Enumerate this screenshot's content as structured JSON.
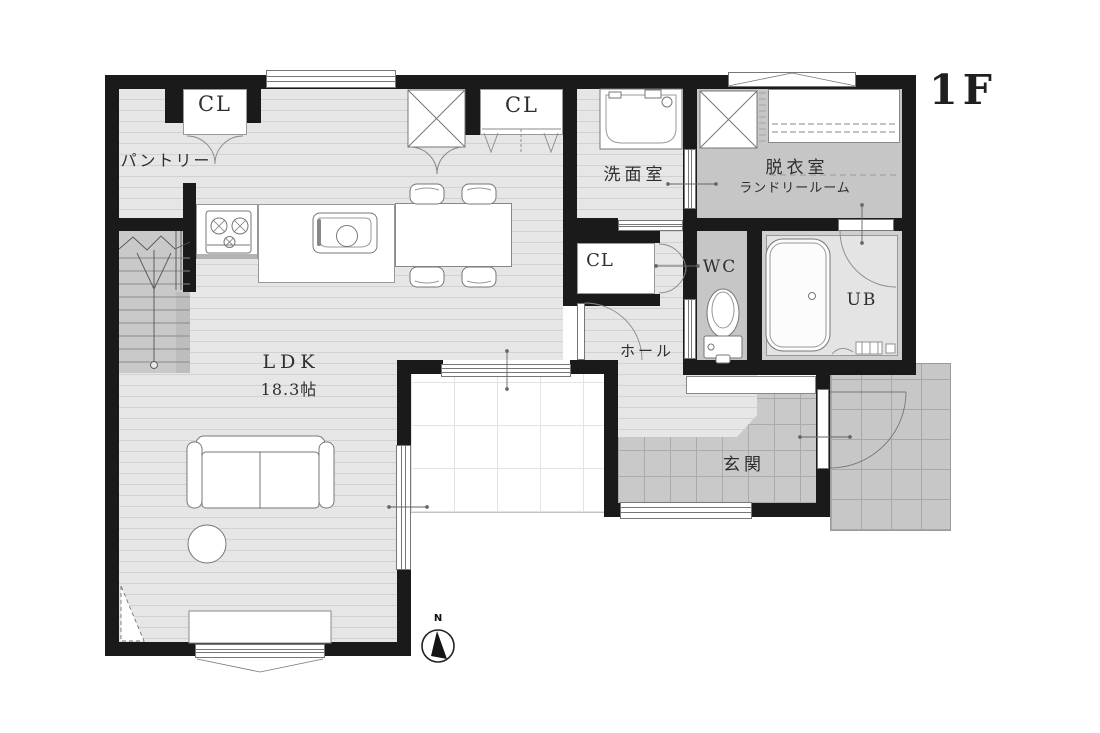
{
  "floor_label": "1F",
  "compass_north": "N",
  "labels": {
    "pantry": "パントリー",
    "closet": "CL",
    "washroom": "洗面室",
    "dressing_room": "脱衣室",
    "laundry_room": "ランドリールーム",
    "wc": "WC",
    "unit_bath": "UB",
    "hall": "ホール",
    "ldk": "LDK",
    "ldk_size": "18.3帖",
    "entrance": "玄関"
  },
  "colors": {
    "wall": "#1a1a1a",
    "wood_floor": "#e6e6e6",
    "wood_floor_line": "#d2d2d2",
    "gray_floor": "#c6c6c6",
    "tile_floor": "#c9c9c9",
    "terrace_grid": "#e3e3e3",
    "text": "#2e2e2e"
  }
}
